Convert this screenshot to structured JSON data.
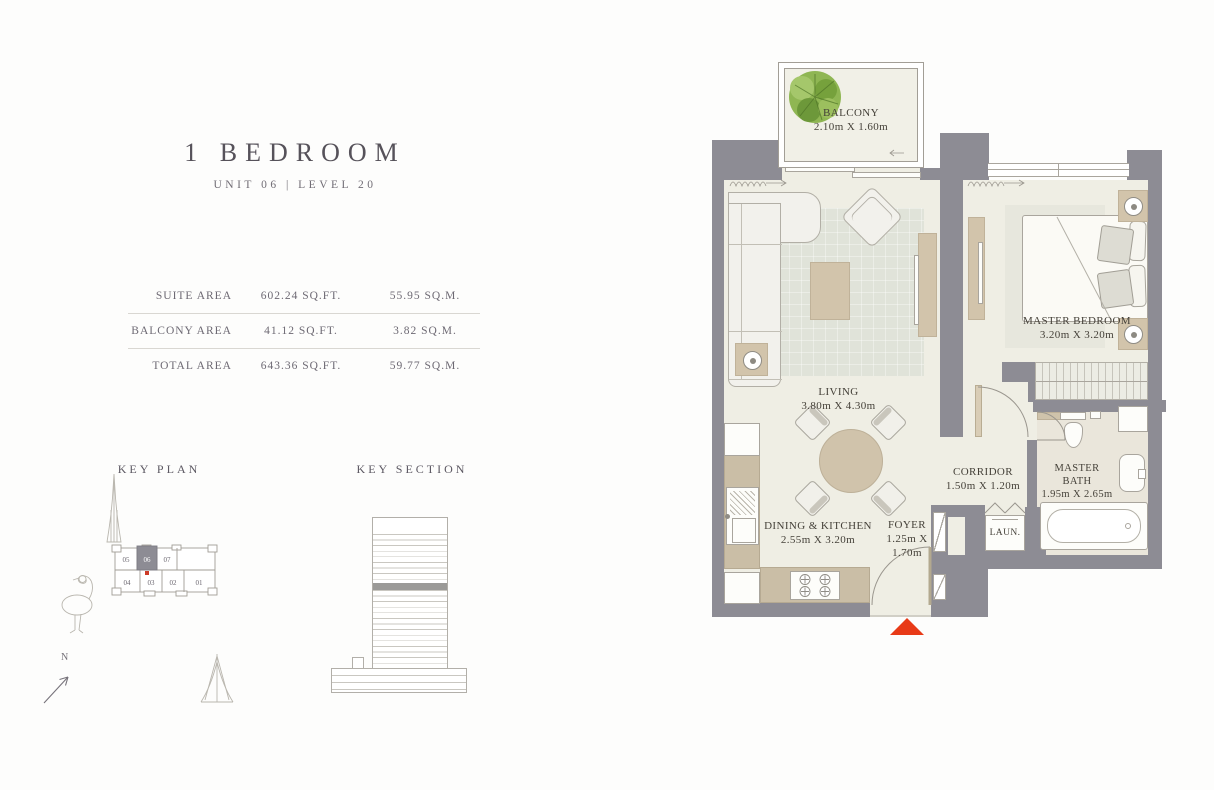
{
  "header": {
    "title": "1 BEDROOM",
    "subtitle": "UNIT 06 | LEVEL 20"
  },
  "area_table": {
    "rows": [
      {
        "label": "SUITE AREA",
        "sqft": "602.24 SQ.FT.",
        "sqm": "55.95 SQ.M."
      },
      {
        "label": "BALCONY AREA",
        "sqft": "41.12 SQ.FT.",
        "sqm": "3.82 SQ.M."
      },
      {
        "label": "TOTAL AREA",
        "sqft": "643.36 SQ.FT.",
        "sqm": "59.77 SQ.M."
      }
    ]
  },
  "key_plan": {
    "title": "KEY PLAN",
    "units": [
      "05",
      "06",
      "07",
      "04",
      "03",
      "02",
      "01"
    ],
    "highlighted_unit": "06"
  },
  "key_section": {
    "title": "KEY SECTION"
  },
  "compass": {
    "north_label": "N"
  },
  "rooms": {
    "balcony": {
      "name": "BALCONY",
      "dims": "2.10m X 1.60m"
    },
    "living": {
      "name": "LIVING",
      "dims": "3.80m X 4.30m"
    },
    "dining_kitchen": {
      "name": "DINING & KITCHEN",
      "dims": "2.55m X 3.20m"
    },
    "foyer": {
      "name": "FOYER",
      "dims": "1.25m X 1.70m"
    },
    "corridor": {
      "name": "CORRIDOR",
      "dims": "1.50m X 1.20m"
    },
    "master_bedroom": {
      "name": "MASTER BEDROOM",
      "dims": "3.20m X 3.20m"
    },
    "master_bath": {
      "name": "MASTER BATH",
      "dims": "1.95m X 2.65m"
    },
    "laundry": {
      "name": "LAUN."
    }
  },
  "colors": {
    "wall": "#8d8c94",
    "entry_marker": "#e83a17",
    "tree_green": "#86ad47",
    "accent_tan": "#d2c4ab"
  }
}
